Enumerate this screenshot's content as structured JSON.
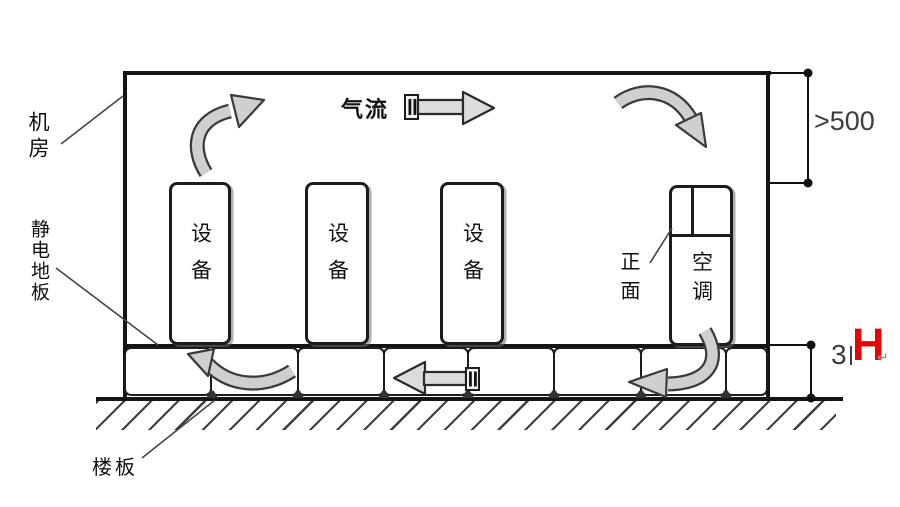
{
  "diagram": {
    "room_label": "机房",
    "antistatic_floor_label": "静电地板",
    "slab_label": "楼板",
    "airflow_label": "气流",
    "front_label": "正面",
    "ac_unit_label": "空调",
    "equipment_cabinets": [
      {
        "label": "设备"
      },
      {
        "label": "设备"
      },
      {
        "label": "设备"
      }
    ],
    "dimensions": {
      "ceiling_clearance": ">500",
      "raised_floor_height_clipped": "3",
      "raised_floor_height_symbol": "H",
      "paragraph_mark": "↵"
    },
    "colors": {
      "line_color": "#1a1a1a",
      "arrow_fill": "#cfcfcf",
      "height_symbol_red": "#e60505"
    }
  }
}
